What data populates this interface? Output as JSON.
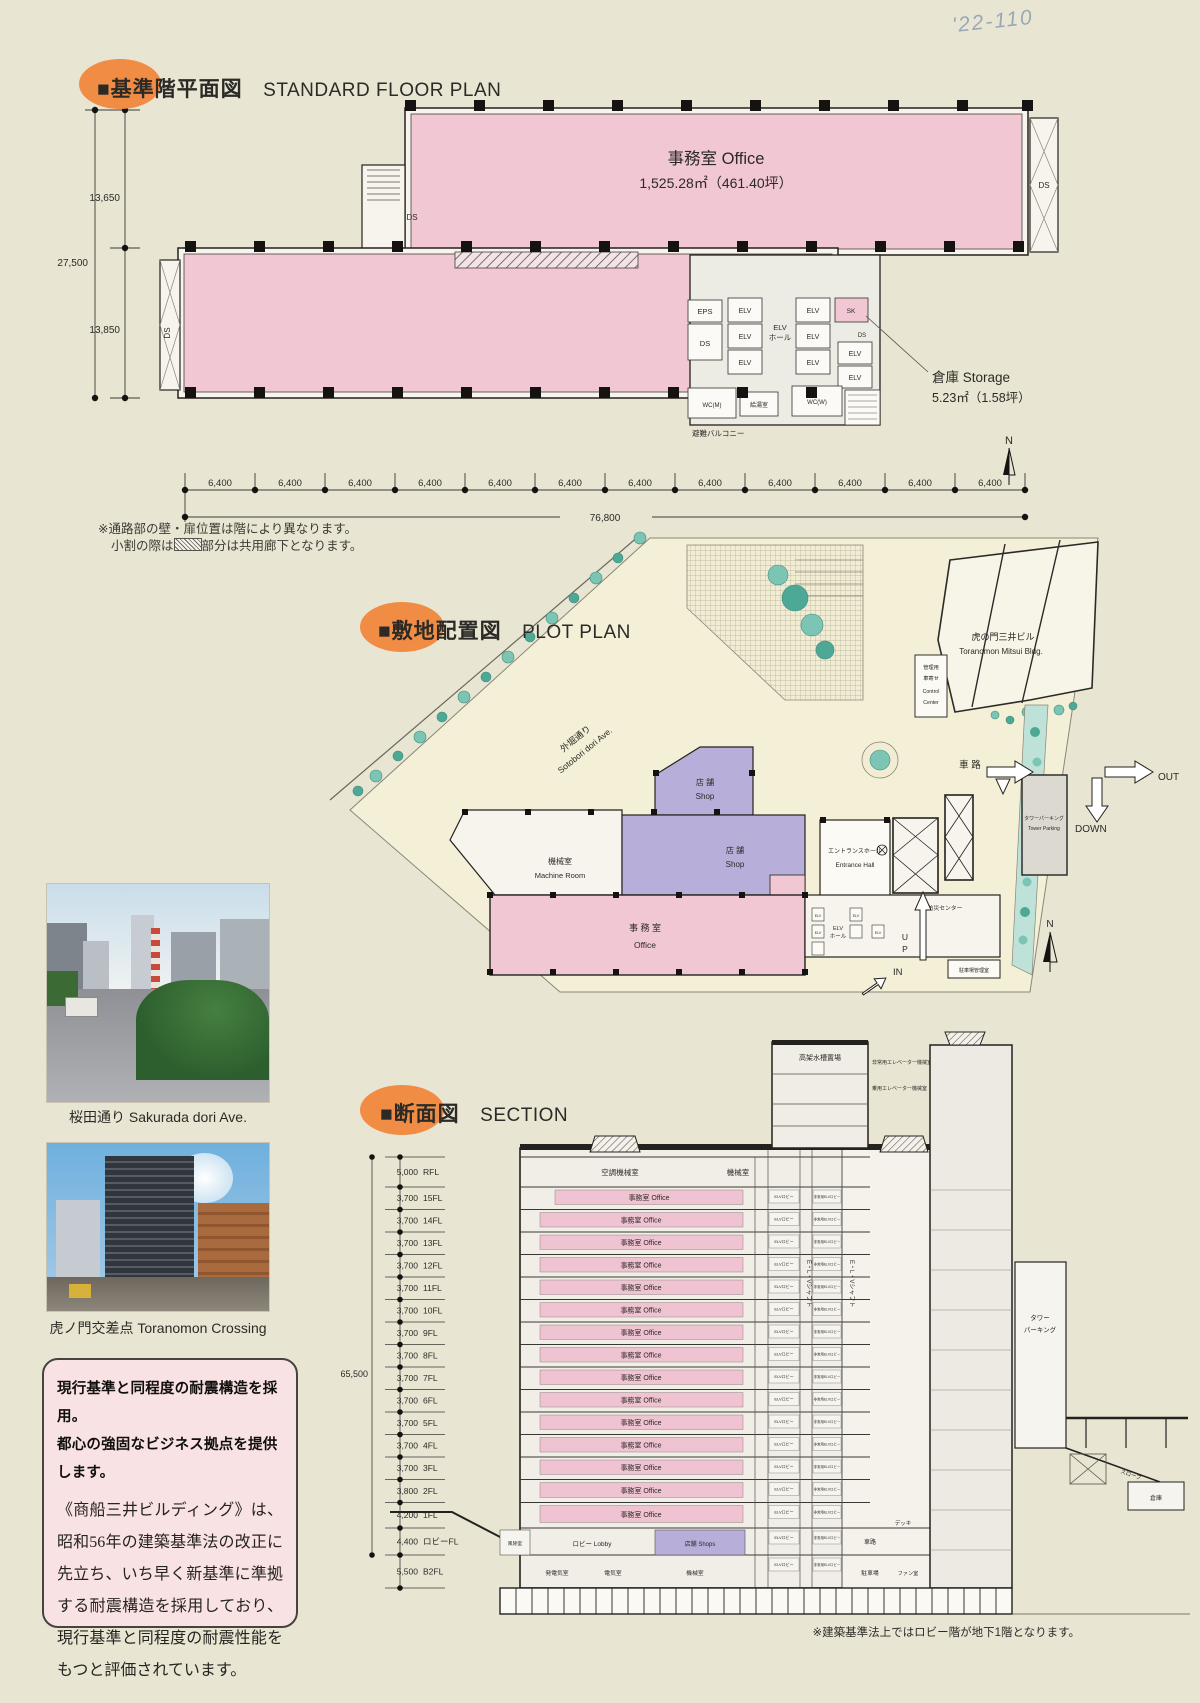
{
  "page": {
    "handwriting": "'22-110"
  },
  "plan": {
    "title_jp": "■基準階平面図",
    "title_en": "STANDARD FLOOR PLAN",
    "office": {
      "name": "事務室  Office",
      "area": "1,525.28㎡（461.40坪）"
    },
    "storage": {
      "name": "倉庫  Storage",
      "area": "5.23㎡（1.58坪）"
    },
    "rooms": {
      "eps": "EPS",
      "ds": "DS",
      "elv": "ELV",
      "elv_hall_1": "ELV",
      "elv_hall_2": "ホール",
      "sk": "SK",
      "wc_m": "WC(M)",
      "wc_w": "WC(W)",
      "kyutou": "給湯室",
      "balcony": "避難バルコニー"
    },
    "dims": {
      "left_upper": "13,650",
      "left_lower": "13,850",
      "left_total": "27,500",
      "bay": "6,400",
      "total": "76,800"
    },
    "north": "N",
    "notes": {
      "line1": "※通路部の壁・扉位置は階により異なります。",
      "line2a": "小割の際は",
      "line2b": "部分は共用廊下となります。"
    }
  },
  "plot": {
    "title_jp": "■敷地配置図",
    "title_en": "PLOT PLAN",
    "road_jp": "外堀通り",
    "road_en": "Sotobori dori Ave.",
    "neighbor_jp": "虎の門三井ビル",
    "neighbor_en": "Toranomon Mitsui Bldg.",
    "control_1": "管理用",
    "control_2": "車寄せ",
    "control_3": "Control",
    "control_4": "Center",
    "shop_jp": "店 舗",
    "shop_en": "Shop",
    "machine_jp": "機械室",
    "machine_en": "Machine Room",
    "entrance_jp": "エントランスホール",
    "entrance_en": "Entrance Hall",
    "office_jp": "事 務 室",
    "office_en": "Office",
    "elv": "ELV",
    "elv_hall_1": "ELV",
    "elv_hall_2": "ホール",
    "bousai": "防災センター",
    "parking_office": "駐車場管理室",
    "tower_parking_jp": "タワーパーキング",
    "tower_parking_en": "Tower Parking",
    "sharo": "車 路",
    "out": "OUT",
    "down": "DOWN",
    "up_1": "U",
    "up_2": "P",
    "in": "IN",
    "north": "N"
  },
  "photos": {
    "p1_caption": "桜田通り Sakurada dori Ave.",
    "p2_caption": "虎ノ門交差点 Toranomon Crossing"
  },
  "message": {
    "headline1": "現行基準と同程度の耐震構造を採用。",
    "headline2": "都心の強固なビジネス拠点を提供します。",
    "body": "《商船三井ビルディング》は、昭和56年の建築基準法の改正に先立ち、いち早く新基準に準拠する耐震構造を採用しており、現行基準と同程度の耐震性能をもつと評価されています。"
  },
  "section": {
    "title_jp": "■断面図",
    "title_en": "SECTION",
    "total_height": "65,500",
    "scale": [
      {
        "dim": "5,000",
        "label": "RFL"
      },
      {
        "dim": "3,700",
        "label": "15FL"
      },
      {
        "dim": "3,700",
        "label": "14FL"
      },
      {
        "dim": "3,700",
        "label": "13FL"
      },
      {
        "dim": "3,700",
        "label": "12FL"
      },
      {
        "dim": "3,700",
        "label": "11FL"
      },
      {
        "dim": "3,700",
        "label": "10FL"
      },
      {
        "dim": "3,700",
        "label": "9FL"
      },
      {
        "dim": "3,700",
        "label": "8FL"
      },
      {
        "dim": "3,700",
        "label": "7FL"
      },
      {
        "dim": "3,700",
        "label": "6FL"
      },
      {
        "dim": "3,700",
        "label": "5FL"
      },
      {
        "dim": "3,700",
        "label": "4FL"
      },
      {
        "dim": "3,700",
        "label": "3FL"
      },
      {
        "dim": "3,800",
        "label": "2FL"
      },
      {
        "dim": "4,200",
        "label": "1FL"
      },
      {
        "dim": "4,400",
        "label": "ロビーFL"
      },
      {
        "dim": "5,500",
        "label": "B2FL"
      }
    ],
    "roof": {
      "tank": "高架水槽置場",
      "emergency_elv": "非常用エレベーター機械室",
      "passenger_elv": "乗用エレベーター機械室",
      "ac_machine": "空調機械室",
      "machine": "機械室"
    },
    "office_floor": "事務室 Office",
    "elv_lobby": "ELVロビー",
    "emer_elv_lobby": "非常用ELVロビー",
    "elv_shaft": "E・L・Vシャフト",
    "tower_parking_1": "タワー",
    "tower_parking_2": "パーキング",
    "deck": "デッキ",
    "slope": "スロープ",
    "soko": "倉庫",
    "lobby_level": {
      "windbreak": "風除室",
      "lobby": "ロビー  Lobby",
      "shops": "店舗  Shops",
      "sharo": "車路"
    },
    "b2_level": {
      "generator": "発電気室",
      "electrical": "電気室",
      "machine": "機械室",
      "pump": "ポンプ室",
      "parking": "駐車場",
      "fan": "ファン室"
    },
    "note": "※建築基準法上ではロビー階が地下1階となります。"
  }
}
